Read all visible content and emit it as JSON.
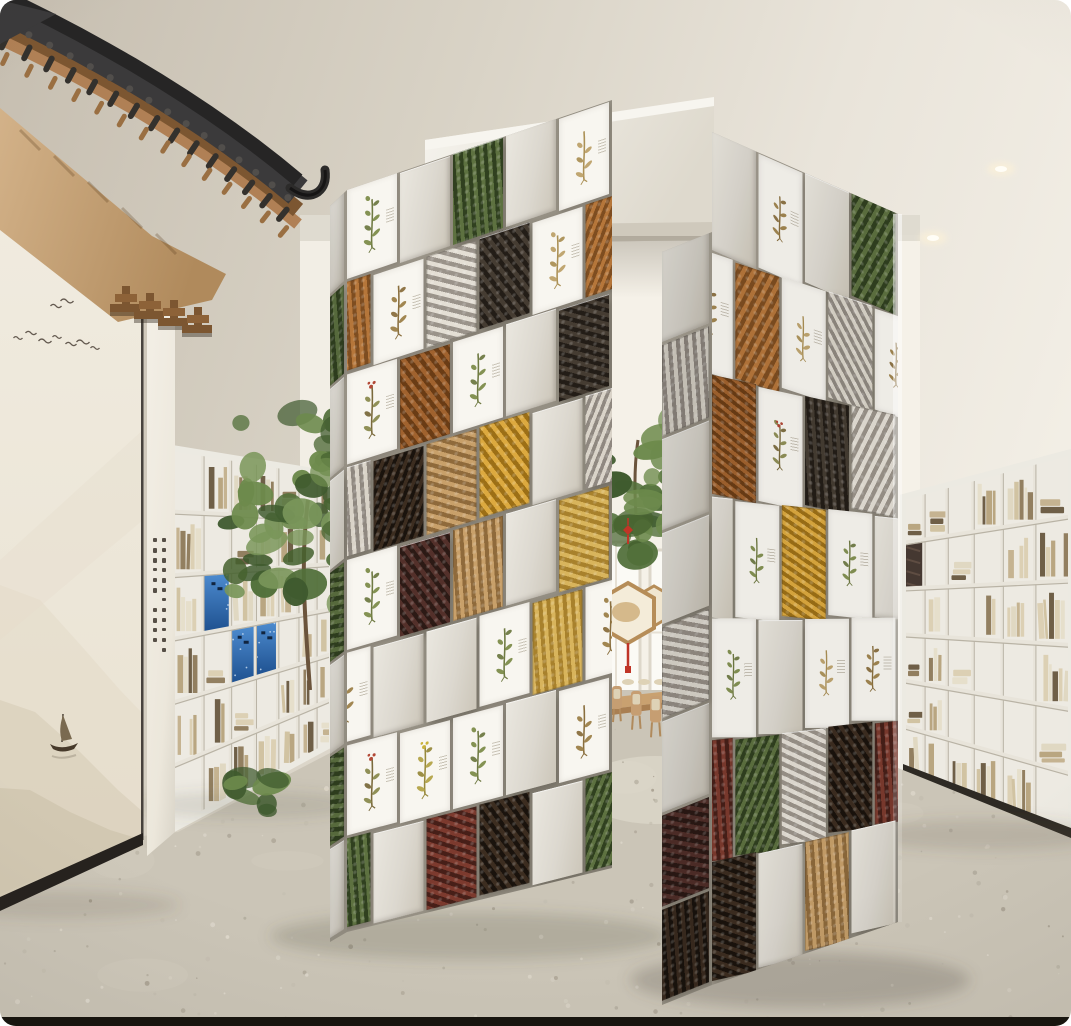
{
  "scene": {
    "label": "chinese-medicine-library-exhibition-render",
    "palette": {
      "ceiling_dark": "#c6beb0",
      "ceiling_mid": "#d8d2c5",
      "ceiling_light": "#f2eee5",
      "back_wall": "#f2eee5",
      "window": "#fbfaf5",
      "eave_tile": "#3b3a3b",
      "eave_tile_dark": "#262525",
      "eave_wood": "#b08055",
      "eave_wood_dark": "#7c5631",
      "eave_soffit_light": "#d3b289",
      "eave_soffit_dark": "#b08a5c",
      "mural_bg": "#f0ebdf",
      "mural_ink": "#4a4036",
      "mountain_far": "#e3dbc9",
      "mountain_mid": "#d8cfba",
      "mountain_near": "#cfc5ae",
      "baseboard": "#26221e",
      "pillar": "#f1ede4",
      "block_face": "#dcd8cf",
      "block_face_light": "#eae7df",
      "block_seam": "#9d978b",
      "print_bg": "#f8f6f0",
      "shelf_white": "#edeae2",
      "shelf_board": "#e8e4da",
      "shelf_shadow": "#b9b3a5",
      "blue_panel": "#3d7cc4",
      "blue_panel_dark": "#1d4f8e",
      "tree_dark": "#3f5a2e",
      "tree_mid": "#52703a",
      "tree_light": "#6d8a4c",
      "knot_red": "#c03527",
      "table_wood": "#c9a170",
      "table_wood_dark": "#a97f52",
      "cushion": "#ded2b6",
      "floor": "#cbc5b7",
      "floor_speck_dark": "#b1ab9d",
      "floor_speck_light": "#e2dcd0",
      "light_core": "#fffdf6",
      "light_glow": "#fff3d6"
    },
    "lights": [
      {
        "x": 1001,
        "y": 169
      },
      {
        "x": 933,
        "y": 238
      }
    ],
    "mural": {
      "birds": [
        [
          18,
          338
        ],
        [
          31,
          333
        ],
        [
          45,
          341
        ],
        [
          57,
          337
        ],
        [
          71,
          344
        ],
        [
          83,
          342
        ],
        [
          95,
          348
        ],
        [
          56,
          306
        ],
        [
          67,
          301
        ]
      ],
      "boat": {
        "x": 62,
        "y": 742
      }
    },
    "bookshelves": {
      "left": {
        "cols": 7,
        "rows": 6,
        "blue_cells": [
          [
            1,
            2
          ],
          [
            2,
            3
          ],
          [
            3,
            3
          ]
        ],
        "art_cells": []
      },
      "right": {
        "cols": 6,
        "rows": 6,
        "blue_cells": [],
        "art_cells": [
          [
            0,
            1
          ]
        ]
      }
    },
    "book_colors": [
      "#dcd0b4",
      "#d1c3a2",
      "#c5b391",
      "#b9a681",
      "#e6dfcb",
      "#927f60",
      "#6f5f47",
      "#e0d8c2"
    ],
    "motifs": {
      "bark": [
        "#b5763a",
        "#7e4d20"
      ],
      "cinnamon": [
        "#a0622e",
        "#6a3c15"
      ],
      "roots": [
        "#e3ded4",
        "#9a938a"
      ],
      "fungus": [
        "#d9d3c8",
        "#8f8880"
      ],
      "black": [
        "#231d17",
        "#453c32"
      ],
      "golden": [
        "#dca93f",
        "#9c6f16"
      ],
      "straw": [
        "#d8b45c",
        "#a8812c"
      ],
      "chips": [
        "#c8a06a",
        "#8f6a3b"
      ],
      "berries": [
        "#53302a",
        "#2c1a15"
      ],
      "mushroom": [
        "#3c2d20",
        "#1a130d"
      ],
      "greens": [
        "#5d7140",
        "#30401f"
      ],
      "redroot": [
        "#7c3a2e",
        "#471f18"
      ]
    },
    "prints": {
      "green": {
        "stem": "#6f7a43",
        "leaf": "#7d8c4a",
        "accent": ""
      },
      "brown": {
        "stem": "#8a6f3e",
        "leaf": "#9c7f48",
        "accent": ""
      },
      "tan": {
        "stem": "#ab9055",
        "leaf": "#bda169",
        "accent": ""
      },
      "red": {
        "stem": "#7a6a3c",
        "leaf": "#8a8a4e",
        "accent": "#b24836"
      },
      "yellow": {
        "stem": "#97893c",
        "leaf": "#b3a348",
        "accent": "#c9b23c"
      }
    },
    "portal": {
      "left_wall_rows": [
        [
          "print.green",
          "plain",
          "photo.greens",
          "plain",
          "print.tan"
        ],
        [
          "photo.bark",
          "print.brown",
          "photo.roots",
          "photo.black",
          "print.tan"
        ],
        [
          "print.red",
          "photo.cinnamon",
          "print.green",
          "plain",
          "photo.black"
        ],
        [
          "photo.fungus",
          "photo.mushroom",
          "photo.chips",
          "photo.golden",
          "plain"
        ],
        [
          "print.green",
          "photo.berries",
          "photo.chips",
          "plain",
          "photo.straw"
        ],
        [
          "print.brown",
          "plain",
          "plain",
          "print.green",
          "photo.straw"
        ],
        [
          "print.red",
          "print.yellow",
          "print.green",
          "plain",
          "print.brown"
        ],
        [
          "photo.greens",
          "plain",
          "photo.redroot",
          "photo.mushroom",
          "plain"
        ]
      ],
      "left_wall_edge": [
        "plain",
        "photo.greens",
        "plain",
        "plain",
        "photo.greens",
        "plain",
        "photo.greens",
        "plain"
      ],
      "right_wall_rows": [
        [
          "plain",
          "print.brown",
          "plain",
          "photo.greens"
        ],
        [
          "print.brown",
          "photo.bark",
          "print.tan",
          "photo.fungus"
        ],
        [
          "photo.cinnamon",
          "print.red",
          "photo.black",
          "photo.roots"
        ],
        [
          "plain",
          "print.green",
          "photo.golden",
          "print.green"
        ],
        [
          "print.green",
          "plain",
          "print.tan",
          "print.brown"
        ],
        [
          "photo.redroot",
          "photo.greens",
          "photo.roots",
          "photo.mushroom"
        ],
        [
          "photo.mushroom",
          "plain",
          "photo.chips",
          "plain"
        ]
      ],
      "right_wall_end": [
        "plain",
        "photo.fungus",
        "plain",
        "plain",
        "photo.roots",
        "plain",
        "photo.berries",
        "photo.mushroom"
      ]
    },
    "ornaments": {
      "hexagon_count": 2,
      "knot_positions": [
        [
          602,
          487
        ],
        [
          628,
          530
        ],
        [
          667,
          452
        ]
      ],
      "tassel_red": "#c03527"
    },
    "furniture": {
      "chair_count": 5
    }
  }
}
